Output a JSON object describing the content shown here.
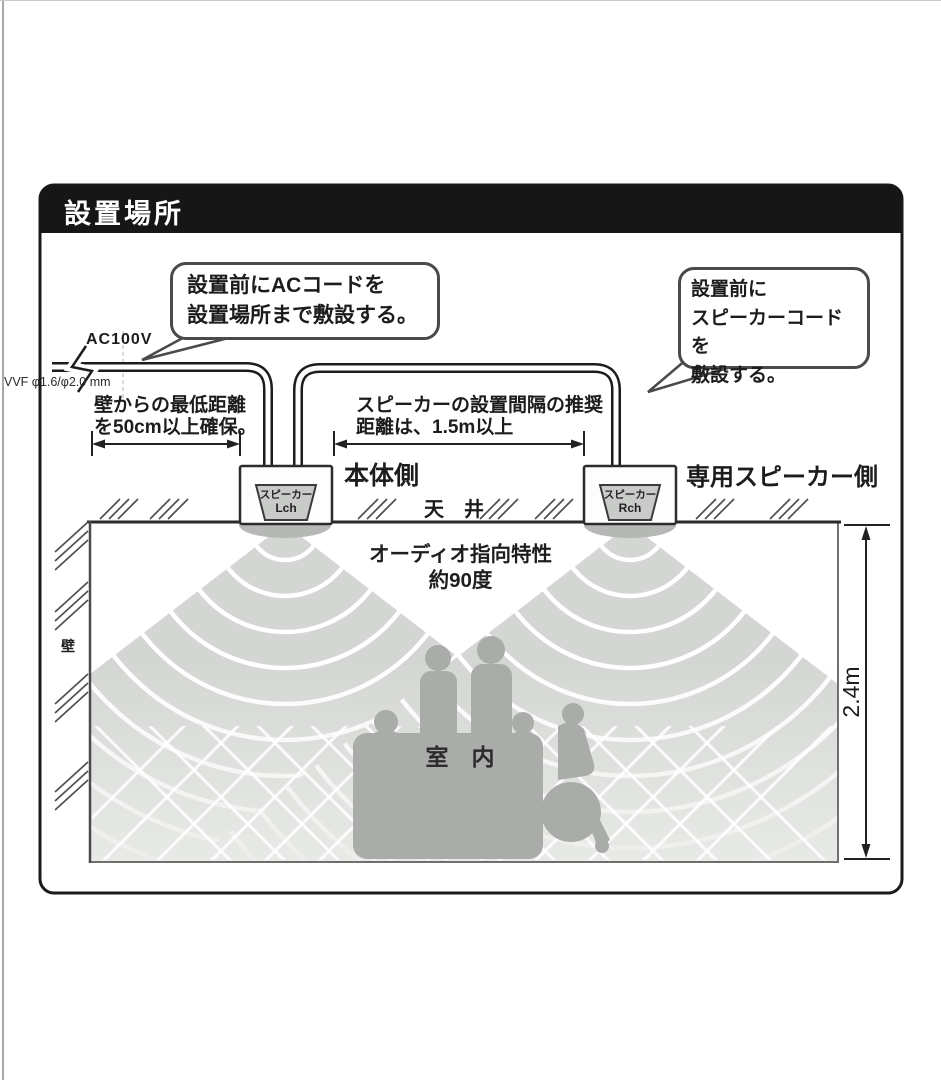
{
  "title": "設置場所",
  "callout_ac": {
    "line1": "設置前にACコードを",
    "line2": "設置場所まで敷設する。"
  },
  "callout_speaker": {
    "line1": "設置前に",
    "line2": "スピーカーコードを",
    "line3": "敷設する。"
  },
  "labels": {
    "ac_power": "AC100V",
    "cable_spec": "VVF φ1.6/φ2.0 mm",
    "wall_distance_1": "壁からの最低距離",
    "wall_distance_2": "を50cm以上確保。",
    "spacing_1": "スピーカーの設置間隔の推奨",
    "spacing_2": "距離は、1.5m以上",
    "main_unit_side": "本体側",
    "speaker_side": "専用スピーカー側",
    "ceiling": "天　井",
    "wall": "壁",
    "directivity_1": "オーディオ指向特性",
    "directivity_2": "約90度",
    "room": "室　内",
    "height": "2.4m",
    "speaker_l_1": "スピーカー",
    "speaker_l_2": "Lch",
    "speaker_r_1": "スピーカー",
    "speaker_r_2": "Rch"
  },
  "colors": {
    "header_bg": "#161616",
    "line": "#1c1c1c",
    "cone_gray": "#d4d6d3",
    "silhouette_gray": "#a9aca9",
    "bubble_border": "#4a4a4a"
  }
}
